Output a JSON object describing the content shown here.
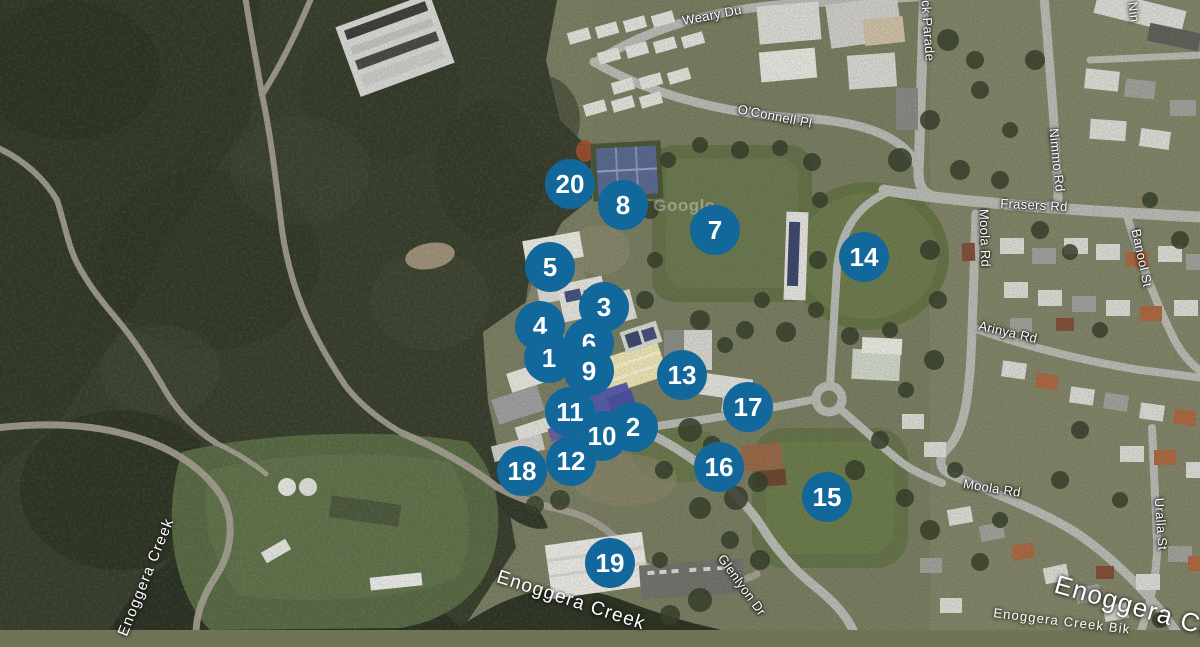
{
  "map": {
    "watermark": "Google",
    "marker_style": {
      "fill_color": "#12689b",
      "text_color": "#ffffff",
      "diameter_px": 50
    },
    "markers": [
      {
        "n": "1",
        "x": 549,
        "y": 358,
        "z": 6
      },
      {
        "n": "2",
        "x": 633,
        "y": 427,
        "z": 4
      },
      {
        "n": "3",
        "x": 604,
        "y": 307,
        "z": 6
      },
      {
        "n": "4",
        "x": 540,
        "y": 326,
        "z": 2
      },
      {
        "n": "5",
        "x": 550,
        "y": 267,
        "z": 5
      },
      {
        "n": "6",
        "x": 589,
        "y": 343,
        "z": 1
      },
      {
        "n": "7",
        "x": 715,
        "y": 230,
        "z": 5
      },
      {
        "n": "8",
        "x": 623,
        "y": 205,
        "z": 5
      },
      {
        "n": "9",
        "x": 589,
        "y": 371,
        "z": 7
      },
      {
        "n": "10",
        "x": 602,
        "y": 436,
        "z": 7
      },
      {
        "n": "11",
        "x": 570,
        "y": 412,
        "z": 3
      },
      {
        "n": "12",
        "x": 571,
        "y": 461,
        "z": 4
      },
      {
        "n": "13",
        "x": 682,
        "y": 375,
        "z": 5
      },
      {
        "n": "14",
        "x": 864,
        "y": 257,
        "z": 5
      },
      {
        "n": "15",
        "x": 827,
        "y": 497,
        "z": 5
      },
      {
        "n": "16",
        "x": 719,
        "y": 467,
        "z": 5
      },
      {
        "n": "17",
        "x": 748,
        "y": 407,
        "z": 5
      },
      {
        "n": "18",
        "x": 522,
        "y": 471,
        "z": 3
      },
      {
        "n": "19",
        "x": 610,
        "y": 563,
        "z": 5
      },
      {
        "n": "20",
        "x": 570,
        "y": 184,
        "z": 5
      }
    ],
    "labels": [
      {
        "text": "Weary Du",
        "x": 712,
        "y": 15,
        "rot": -11,
        "size": 13,
        "kind": "road"
      },
      {
        "text": "O'Connell Pl",
        "x": 775,
        "y": 116,
        "rot": 11,
        "size": 13,
        "kind": "road"
      },
      {
        "text": "Barrack Parade",
        "x": 927,
        "y": 14,
        "rot": 86,
        "size": 13,
        "kind": "road"
      },
      {
        "text": "Frasers Rd",
        "x": 1034,
        "y": 205,
        "rot": 3,
        "size": 13,
        "kind": "road"
      },
      {
        "text": "Nimmo Rd",
        "x": 1057,
        "y": 160,
        "rot": 84,
        "size": 13,
        "kind": "road"
      },
      {
        "text": "Nin",
        "x": 1134,
        "y": 12,
        "rot": 82,
        "size": 13,
        "kind": "road"
      },
      {
        "text": "Moola Rd",
        "x": 985,
        "y": 238,
        "rot": 88,
        "size": 13,
        "kind": "road"
      },
      {
        "text": "Arinya Rd",
        "x": 1008,
        "y": 332,
        "rot": 13,
        "size": 13,
        "kind": "road"
      },
      {
        "text": "Banool St",
        "x": 1142,
        "y": 258,
        "rot": 78,
        "size": 13,
        "kind": "road"
      },
      {
        "text": "Moola Rd",
        "x": 992,
        "y": 488,
        "rot": 9,
        "size": 13,
        "kind": "road"
      },
      {
        "text": "Uralla St",
        "x": 1161,
        "y": 524,
        "rot": 86,
        "size": 13,
        "kind": "road"
      },
      {
        "text": "Glenlyon Dr",
        "x": 742,
        "y": 585,
        "rot": 54,
        "size": 13,
        "kind": "road"
      },
      {
        "text": "Enoggera Creek",
        "x": 146,
        "y": 577,
        "rot": -68,
        "size": 15,
        "kind": "water"
      },
      {
        "text": "Enoggera Creek",
        "x": 571,
        "y": 601,
        "rot": 18,
        "size": 19,
        "kind": "water"
      },
      {
        "text": "Enoggera Cre",
        "x": 1140,
        "y": 608,
        "rot": 16,
        "size": 26,
        "kind": "water"
      },
      {
        "text": "Enoggera Creek Bik",
        "x": 1062,
        "y": 621,
        "rot": 7,
        "size": 13,
        "kind": "water"
      },
      {
        "text": "Google",
        "x": 684,
        "y": 206,
        "rot": 0,
        "size": 17,
        "kind": "watermark",
        "opacity": 0.32
      }
    ]
  }
}
